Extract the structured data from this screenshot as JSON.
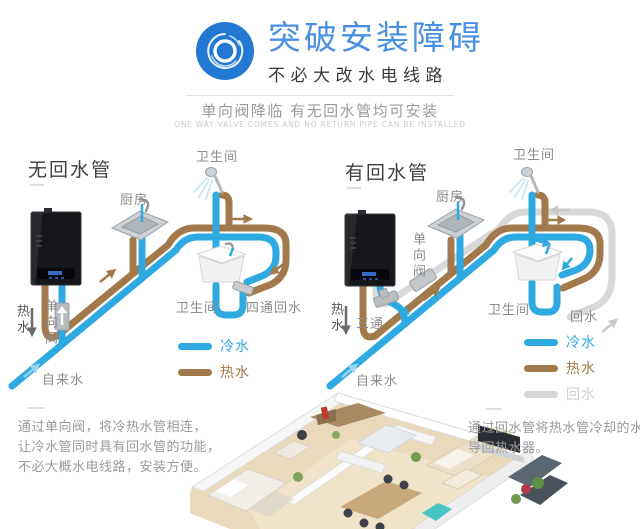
{
  "header": {
    "icon": "concentric-circles-icon",
    "title": "突破安装障碍",
    "subtitle": "不必大改水电线路",
    "tagline": "单向阀降临 有无回水管均可安装",
    "tagline_en": "ONE WAY VALVE COMES AND NO RETURN PIPE CAN BE INSTALLED"
  },
  "colors": {
    "accent_blue": "#2379d2",
    "title_blue": "#4a90e2",
    "cold_pipe": "#2fa9e1",
    "hot_pipe": "#a2794a",
    "return_pipe": "#d5d5d5"
  },
  "left_diagram": {
    "heading": "无回水管",
    "labels": {
      "bathroom_top": "卫生间",
      "kitchen": "厨房",
      "bathroom_bottom": "卫生间",
      "four_way_return": "四通回水",
      "hot_water": "热水",
      "one_way_valve": "单向阀",
      "tap_water": "自来水"
    },
    "legend": [
      {
        "label": "冷水",
        "color": "#2fa9e1"
      },
      {
        "label": "热水",
        "color": "#a2794a"
      }
    ]
  },
  "right_diagram": {
    "heading": "有回水管",
    "labels": {
      "bathroom_top": "卫生间",
      "kitchen": "厨房",
      "one_way_valve": "单向阀",
      "three_way": "三通",
      "hot_water": "热水",
      "tap_water": "自来水",
      "bathroom_bottom": "卫生间",
      "return_water": "回水"
    },
    "legend": [
      {
        "label": "冷水",
        "color": "#2fa9e1"
      },
      {
        "label": "热水",
        "color": "#a2794a"
      },
      {
        "label": "回水",
        "color": "#d5d5d5"
      }
    ]
  },
  "footer": {
    "left_note_lines": [
      "通过单向阀，将冷热水管相连，",
      "让冷水管同时具有回水管的功能，",
      "不必大概水电线路，安装方便。"
    ],
    "right_note_lines": [
      "通过回水管将热水管冷却的水",
      "导回热水器。"
    ]
  }
}
